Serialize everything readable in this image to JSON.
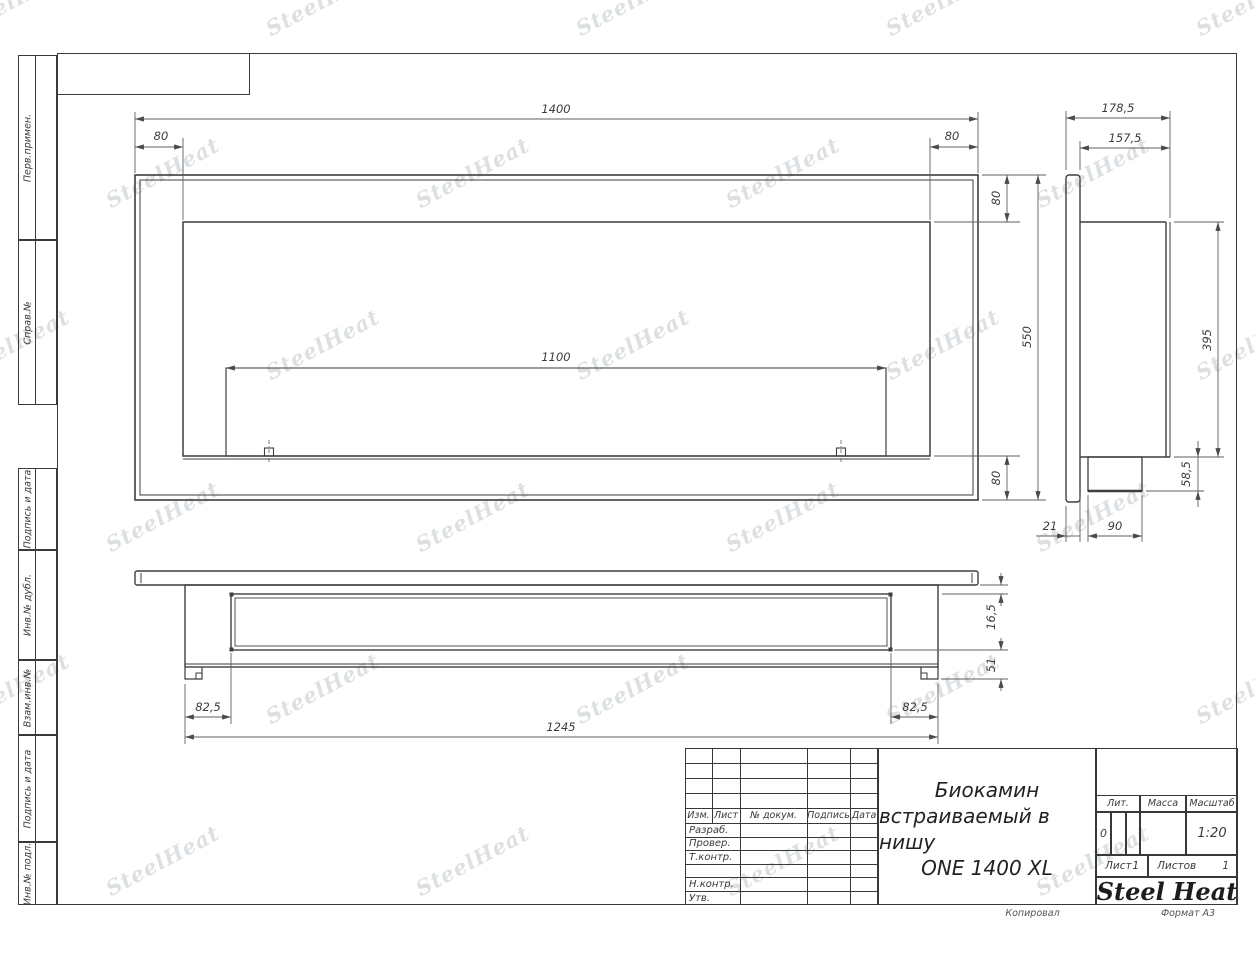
{
  "watermark": {
    "text": "SteelHeat"
  },
  "left_margin": {
    "cells": [
      {
        "label": "Перв.примен."
      },
      {
        "label": "Справ.№"
      },
      {
        "label": "Подпись и дата"
      },
      {
        "label": "Инв.№ дубл."
      },
      {
        "label": "Взам.инв.№"
      },
      {
        "label": "Подпись и дата"
      },
      {
        "label": "Инв.№ подл."
      }
    ]
  },
  "views": {
    "front": {
      "dim_width": "1400",
      "dim_inset_left": "80",
      "dim_inset_right": "80",
      "dim_burner_width": "1100",
      "dim_top_offset": "80",
      "dim_height": "550",
      "dim_bottom_offset": "80"
    },
    "side": {
      "dim_depth_total": "178,5",
      "dim_depth_body": "157,5",
      "dim_body_height": "395",
      "dim_tray_height": "58,5",
      "dim_flange_thickness": "21",
      "dim_tray_depth": "90"
    },
    "bottom": {
      "dim_front_offset": "16,5",
      "dim_back_offset": "51",
      "dim_side_offset_left": "82,5",
      "dim_side_offset_right": "82,5",
      "dim_body_width": "1245"
    }
  },
  "title_block": {
    "title_line1": "Биокамин",
    "title_line2": "встраиваемый в нишу",
    "title_line3": "ONE 1400 XL",
    "rev_table": {
      "col_izm": "Изм.",
      "col_list": "Лист",
      "col_doc": "№ докум.",
      "col_sign": "Подпись",
      "col_date": "Дата",
      "row_developed": "Разраб.",
      "row_checked": "Провер.",
      "row_tcontrol": "Т.контр.",
      "row_ncontrol": "Н.контр.",
      "row_approved": "Утв."
    },
    "lit_label": "Лит.",
    "lit_value": "0",
    "mass_label": "Масса",
    "scale_label": "Масштаб",
    "scale_value": "1:20",
    "sheet_label": "Лист",
    "sheet_value": "1",
    "sheets_label": "Листов",
    "sheets_value": "1",
    "logo": {
      "steel": "Steel",
      "heat": "Heat",
      "flame_color": "#e2261c"
    }
  },
  "footer": {
    "copied": "Копировал",
    "format": "Формат А3"
  }
}
